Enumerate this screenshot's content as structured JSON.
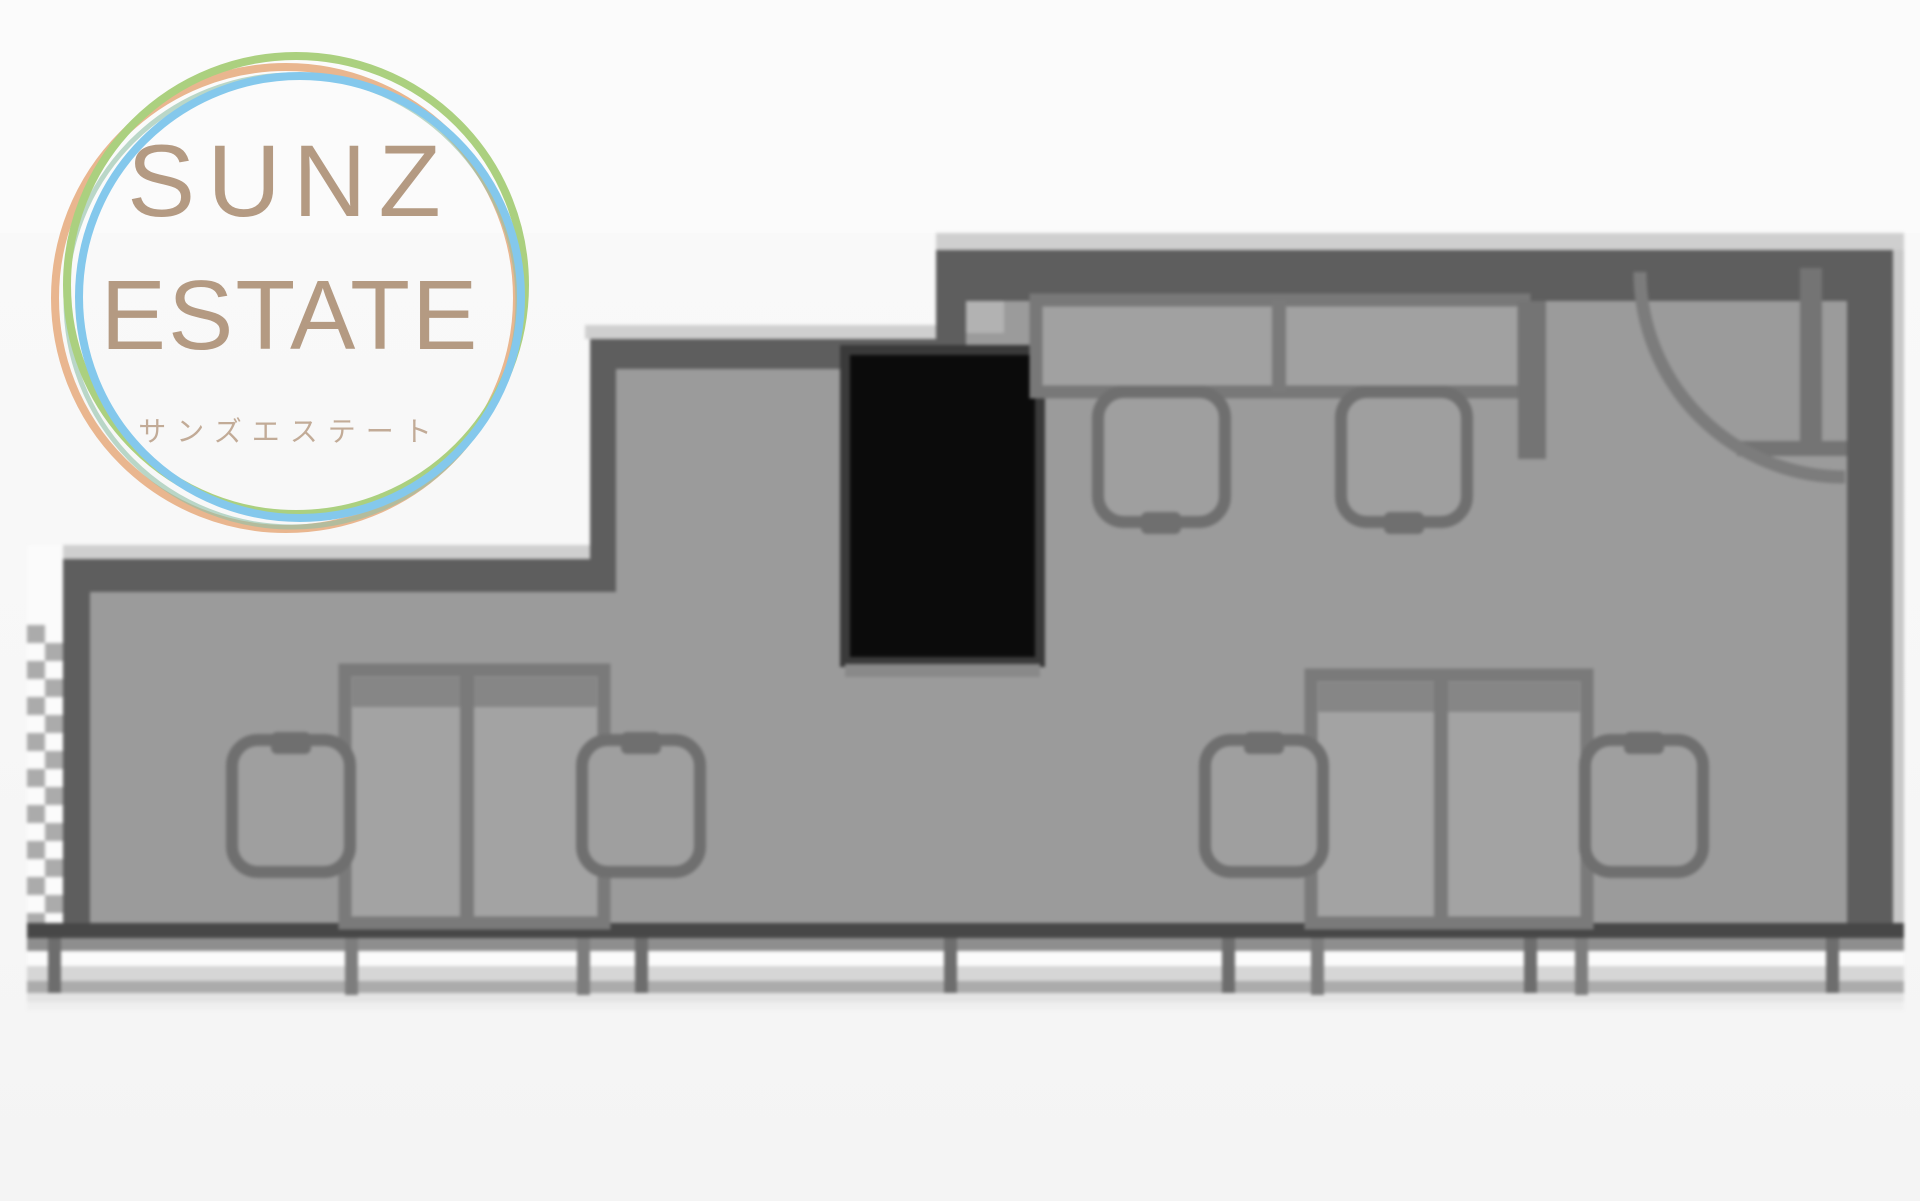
{
  "logo": {
    "title_line1": "SUNZ",
    "title_line2": "ESTATE",
    "subtitle": "サンズエステート"
  },
  "floor_plan": {
    "description": "blurred monochrome office floor plan",
    "rooms": {
      "upper_right_section": "two tables with two chairs and entrance door with quarter-circle swing arc",
      "main_section": "open floor with two double-desk clusters, each flanked by two chairs",
      "left_edge": "hatched window strip",
      "bottom_edge": "balcony band with railing posts",
      "black_block": "solid black rectangle (pillar/shaft)"
    }
  },
  "colors": {
    "page_bg": "#f8f8f8",
    "top_bg": "#fbfbfb",
    "floor": "#9b9b9b",
    "wall": "#5e5e5e",
    "wall_dark": "#474747",
    "wall_light": "#cfcfcf",
    "outline": "#747474",
    "desk_fill": "#a3a3a3",
    "desk_band": "#868686",
    "black_block": "#0b0b0b",
    "balcony_white": "#fbfbfb",
    "brand_text": "#b49a82",
    "subtitle_text": "#c2ab97",
    "ring_green": "#abd07f",
    "ring_orange": "#e9b68f",
    "ring_blue": "#84c8ec",
    "ring_teal": "#8fbfa7"
  }
}
